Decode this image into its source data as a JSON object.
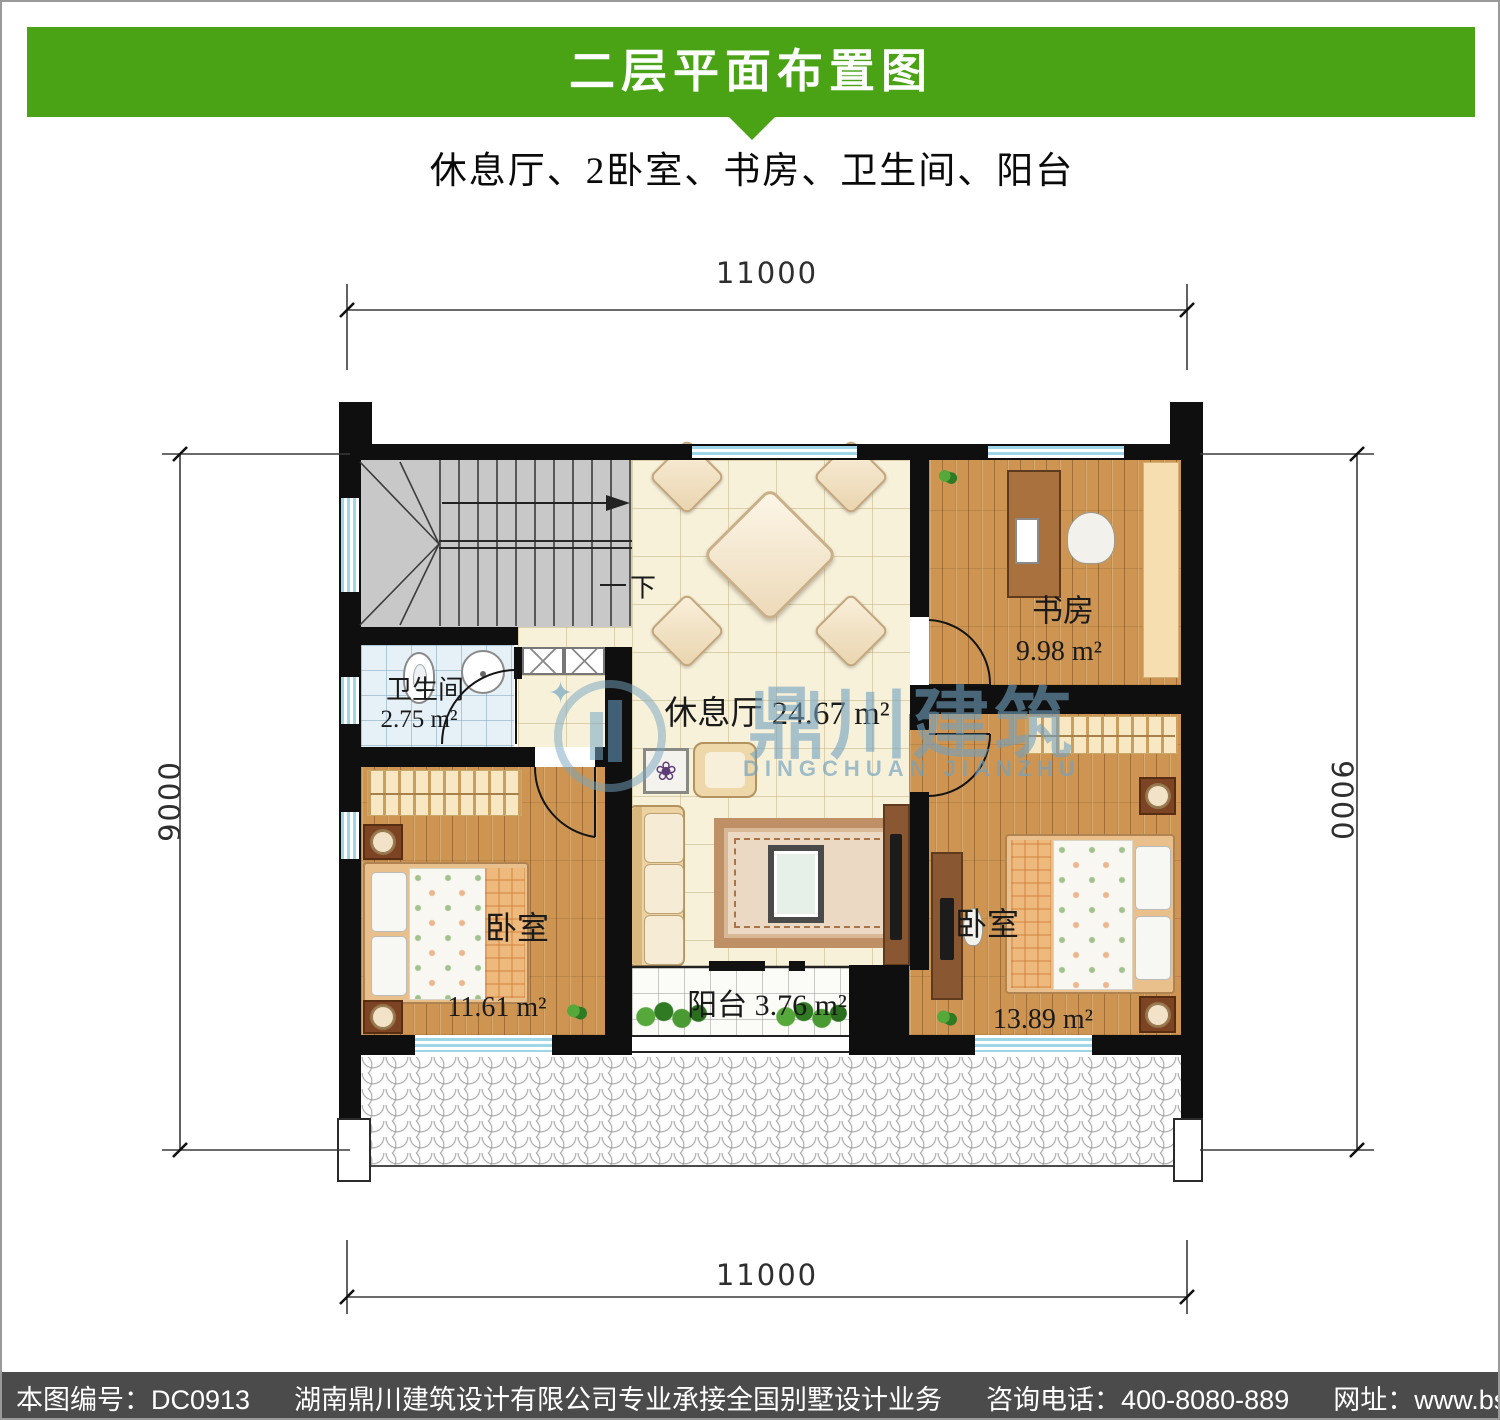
{
  "header": {
    "title": "二层平面布置图",
    "subtitle": "休息厅、2卧室、书房、卫生间、阳台",
    "bar_color": "#4aa315"
  },
  "dims": {
    "top": "11000",
    "bottom": "11000",
    "left": "9000",
    "right": "9000"
  },
  "rooms": {
    "lounge": {
      "name": "休息厅",
      "area": "24.67 m²"
    },
    "study": {
      "name": "书房",
      "area": "9.98 m²"
    },
    "bathroom": {
      "name": "卫生间",
      "area": "2.75 m²"
    },
    "bedroom_left": {
      "name": "卧室",
      "area": "11.61 m²"
    },
    "bedroom_right": {
      "name": "卧室",
      "area": "13.89 m²"
    },
    "balcony": {
      "name": "阳台",
      "area": "3.76 m²"
    }
  },
  "stairs": {
    "down_label": "下",
    "direction_icon": "right-arrow-icon"
  },
  "watermark": {
    "cn": "鼎川建筑",
    "en": "DINGCHUAN JIANZHU",
    "logo_icon": "building-logo-icon",
    "color": "#72a2c0"
  },
  "decor": {
    "picture_flower_icon": "❀"
  },
  "footer": {
    "drawing_no": "本图编号：DC0913",
    "company": "湖南鼎川建筑设计有限公司专业承接全国别墅设计业务",
    "phone": "咨询电话：400-8080-889",
    "website": "网址：www.bstzcs.com",
    "bar_color": "#4b4b4b"
  },
  "colors": {
    "wall_black": "#0f0f0f",
    "window_cyan": "#9ed6e8",
    "stairs_gray": "#c8c8c8"
  }
}
